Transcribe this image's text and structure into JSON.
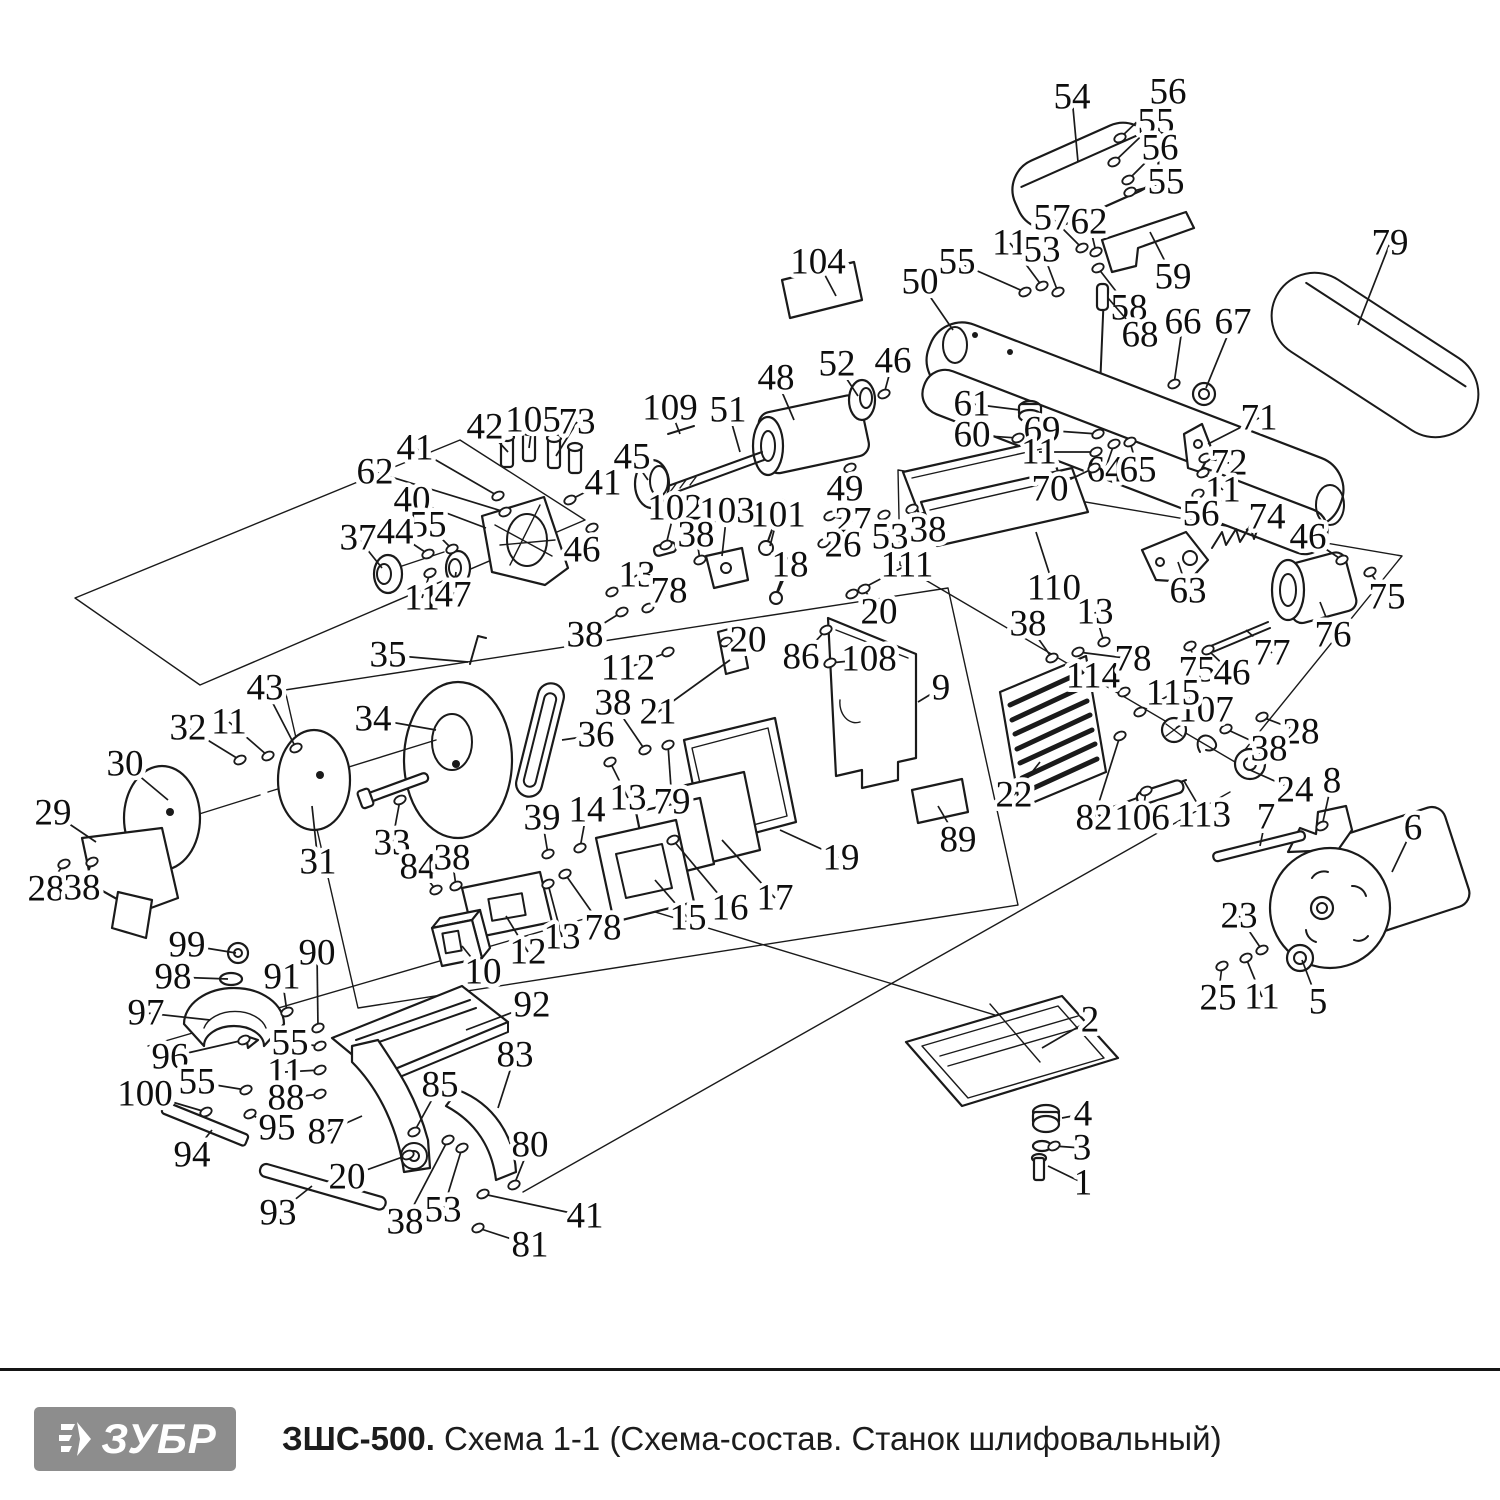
{
  "colors": {
    "line": "#1a1a1a",
    "logo_bg": "#8d8d8d",
    "logo_text": "#ffffff",
    "title_text": "#1c1c1c"
  },
  "footer": {
    "brand": "ЗУБР",
    "model": "ЗШС-500.",
    "subtitle": " Схема 1-1 (Схема-состав. Станок шлифовальный)"
  },
  "diagram": {
    "description": "Exploded-view parts diagram of belt/disc grinding machine",
    "callouts": [
      [
        "54",
        1072,
        97,
        1078,
        162,
        0
      ],
      [
        "56",
        1168,
        92,
        1120,
        138,
        1
      ],
      [
        "55",
        1156,
        122,
        1114,
        162,
        1
      ],
      [
        "56",
        1160,
        148,
        1128,
        180,
        1
      ],
      [
        "55",
        1166,
        182,
        1130,
        192,
        1
      ],
      [
        "57",
        1052,
        218,
        1082,
        248,
        1
      ],
      [
        "62",
        1089,
        222,
        1096,
        252,
        1
      ],
      [
        "59",
        1173,
        277,
        1150,
        232,
        0
      ],
      [
        "58",
        1129,
        308,
        1098,
        268,
        1
      ],
      [
        "68",
        1140,
        335,
        1108,
        298,
        0
      ],
      [
        "11",
        1010,
        243,
        1042,
        286,
        1
      ],
      [
        "53",
        1042,
        250,
        1058,
        292,
        1
      ],
      [
        "55",
        957,
        262,
        1025,
        292,
        1
      ],
      [
        "50",
        920,
        282,
        953,
        330,
        0
      ],
      [
        "104",
        818,
        262,
        836,
        296,
        0
      ],
      [
        "79",
        1390,
        243,
        1358,
        325,
        0
      ],
      [
        "66",
        1183,
        322,
        1174,
        384,
        1
      ],
      [
        "67",
        1233,
        322,
        1206,
        388,
        0
      ],
      [
        "71",
        1259,
        418,
        1208,
        444,
        0
      ],
      [
        "72",
        1229,
        463,
        1205,
        458,
        1
      ],
      [
        "11",
        1223,
        490,
        1203,
        473,
        1
      ],
      [
        "56",
        1201,
        514,
        1198,
        494,
        1
      ],
      [
        "74",
        1267,
        517,
        1246,
        530,
        0
      ],
      [
        "64",
        1105,
        470,
        1114,
        444,
        1
      ],
      [
        "65",
        1138,
        470,
        1130,
        442,
        1
      ],
      [
        "69",
        1042,
        430,
        1098,
        434,
        1
      ],
      [
        "11",
        1039,
        452,
        1096,
        452,
        1
      ],
      [
        "61",
        972,
        404,
        1020,
        410,
        0
      ],
      [
        "60",
        972,
        435,
        1018,
        438,
        1
      ],
      [
        "70",
        1050,
        489,
        1094,
        468,
        1
      ],
      [
        "46",
        1308,
        537,
        1342,
        560,
        1
      ],
      [
        "75",
        1387,
        597,
        1370,
        572,
        1
      ],
      [
        "76",
        1333,
        635,
        1320,
        602,
        0
      ],
      [
        "77",
        1272,
        653,
        1246,
        630,
        0
      ],
      [
        "75",
        1197,
        670,
        1190,
        646,
        1
      ],
      [
        "46",
        1232,
        673,
        1208,
        650,
        1
      ],
      [
        "63",
        1188,
        591,
        1178,
        562,
        0
      ],
      [
        "110",
        1054,
        588,
        1036,
        532,
        0
      ],
      [
        "52",
        837,
        364,
        858,
        396,
        0
      ],
      [
        "46",
        893,
        361,
        884,
        394,
        1
      ],
      [
        "48",
        776,
        378,
        794,
        420,
        0
      ],
      [
        "49",
        845,
        489,
        850,
        468,
        1
      ],
      [
        "51",
        728,
        410,
        740,
        452,
        0
      ],
      [
        "109",
        670,
        408,
        680,
        434,
        0
      ],
      [
        "45",
        632,
        457,
        648,
        480,
        0
      ],
      [
        "27",
        853,
        521,
        830,
        516,
        1
      ],
      [
        "26",
        843,
        545,
        824,
        543,
        1
      ],
      [
        "101",
        778,
        515,
        770,
        546,
        0
      ],
      [
        "102",
        675,
        508,
        666,
        545,
        1
      ],
      [
        "103",
        727,
        511,
        722,
        556,
        0
      ],
      [
        "38",
        696,
        535,
        700,
        560,
        1
      ],
      [
        "53",
        890,
        537,
        884,
        515,
        1
      ],
      [
        "38",
        928,
        530,
        912,
        509,
        1
      ],
      [
        "18",
        790,
        565,
        778,
        592,
        0
      ],
      [
        "111",
        907,
        565,
        852,
        594,
        1
      ],
      [
        "20",
        879,
        612,
        864,
        589,
        1
      ],
      [
        "86",
        801,
        657,
        826,
        630,
        1
      ],
      [
        "108",
        869,
        659,
        830,
        663,
        1
      ],
      [
        "9",
        941,
        688,
        918,
        702,
        0
      ],
      [
        "13",
        637,
        575,
        612,
        592,
        1
      ],
      [
        "78",
        669,
        591,
        648,
        608,
        1
      ],
      [
        "38",
        585,
        635,
        622,
        612,
        1
      ],
      [
        "112",
        628,
        668,
        668,
        652,
        1
      ],
      [
        "21",
        658,
        712,
        730,
        660,
        0
      ],
      [
        "20",
        748,
        640,
        726,
        642,
        1
      ],
      [
        "38",
        613,
        703,
        645,
        750,
        1
      ],
      [
        "36",
        596,
        735,
        562,
        740,
        0
      ],
      [
        "13",
        628,
        798,
        610,
        762,
        1
      ],
      [
        "79",
        672,
        802,
        668,
        745,
        1
      ],
      [
        "19",
        841,
        858,
        780,
        830,
        0
      ],
      [
        "89",
        958,
        840,
        938,
        806,
        0
      ],
      [
        "42",
        485,
        427,
        508,
        452,
        0
      ],
      [
        "105",
        533,
        420,
        529,
        448,
        0
      ],
      [
        "73",
        577,
        422,
        556,
        456,
        0
      ],
      [
        "41",
        415,
        448,
        498,
        496,
        1
      ],
      [
        "62",
        375,
        472,
        505,
        512,
        1
      ],
      [
        "40",
        412,
        500,
        486,
        528,
        0
      ],
      [
        "55",
        428,
        525,
        452,
        549,
        1
      ],
      [
        "44",
        395,
        532,
        428,
        554,
        1
      ],
      [
        "37",
        358,
        538,
        382,
        568,
        0
      ],
      [
        "41",
        603,
        483,
        570,
        500,
        1
      ],
      [
        "46",
        582,
        550,
        592,
        528,
        1
      ],
      [
        "11",
        422,
        598,
        430,
        573,
        1
      ],
      [
        "47",
        453,
        595,
        456,
        572,
        0
      ],
      [
        "35",
        388,
        655,
        468,
        662,
        0
      ],
      [
        "34",
        373,
        719,
        436,
        730,
        0
      ],
      [
        "43",
        265,
        688,
        296,
        748,
        1
      ],
      [
        "11",
        229,
        722,
        268,
        756,
        1
      ],
      [
        "32",
        188,
        728,
        240,
        760,
        1
      ],
      [
        "30",
        125,
        764,
        168,
        800,
        0
      ],
      [
        "29",
        53,
        813,
        96,
        842,
        0
      ],
      [
        "28",
        46,
        889,
        64,
        864,
        1
      ],
      [
        "38",
        82,
        888,
        92,
        862,
        1
      ],
      [
        "31",
        318,
        862,
        312,
        806,
        0
      ],
      [
        "33",
        392,
        843,
        400,
        800,
        1
      ],
      [
        "84",
        418,
        867,
        436,
        890,
        1
      ],
      [
        "38",
        452,
        858,
        456,
        886,
        1
      ],
      [
        "39",
        542,
        818,
        548,
        854,
        1
      ],
      [
        "14",
        587,
        810,
        580,
        848,
        1
      ],
      [
        "13",
        562,
        937,
        548,
        884,
        1
      ],
      [
        "78",
        603,
        928,
        565,
        874,
        1
      ],
      [
        "12",
        528,
        952,
        506,
        916,
        0
      ],
      [
        "10",
        483,
        972,
        462,
        946,
        0
      ],
      [
        "15",
        688,
        918,
        655,
        880,
        0
      ],
      [
        "16",
        730,
        908,
        673,
        840,
        1
      ],
      [
        "17",
        775,
        898,
        722,
        840,
        0
      ],
      [
        "99",
        187,
        945,
        236,
        953,
        0
      ],
      [
        "98",
        173,
        977,
        228,
        979,
        0
      ],
      [
        "97",
        146,
        1013,
        210,
        1020,
        0
      ],
      [
        "91",
        282,
        977,
        287,
        1012,
        1
      ],
      [
        "90",
        317,
        953,
        318,
        1028,
        1
      ],
      [
        "96",
        170,
        1057,
        244,
        1040,
        1
      ],
      [
        "55",
        290,
        1043,
        320,
        1046,
        1
      ],
      [
        "11",
        285,
        1072,
        320,
        1070,
        1
      ],
      [
        "88",
        286,
        1098,
        320,
        1094,
        1
      ],
      [
        "55",
        197,
        1082,
        246,
        1090,
        1
      ],
      [
        "100",
        145,
        1094,
        206,
        1112,
        1
      ],
      [
        "95",
        277,
        1128,
        250,
        1114,
        1
      ],
      [
        "94",
        192,
        1155,
        212,
        1130,
        0
      ],
      [
        "92",
        532,
        1005,
        466,
        1030,
        0
      ],
      [
        "83",
        515,
        1055,
        498,
        1108,
        0
      ],
      [
        "85",
        440,
        1085,
        414,
        1132,
        1
      ],
      [
        "87",
        326,
        1132,
        362,
        1116,
        0
      ],
      [
        "20",
        347,
        1177,
        408,
        1155,
        1
      ],
      [
        "93",
        278,
        1213,
        312,
        1186,
        0
      ],
      [
        "38",
        405,
        1222,
        448,
        1140,
        1
      ],
      [
        "53",
        443,
        1210,
        462,
        1148,
        1
      ],
      [
        "80",
        530,
        1145,
        514,
        1185,
        1
      ],
      [
        "41",
        585,
        1216,
        483,
        1194,
        1
      ],
      [
        "81",
        530,
        1245,
        478,
        1228,
        1
      ],
      [
        "22",
        1014,
        795,
        1040,
        762,
        0
      ],
      [
        "82",
        1094,
        818,
        1120,
        736,
        1
      ],
      [
        "106",
        1142,
        818,
        1146,
        791,
        1
      ],
      [
        "113",
        1204,
        815,
        1184,
        781,
        0
      ],
      [
        "24",
        1295,
        790,
        1250,
        770,
        0
      ],
      [
        "28",
        1301,
        732,
        1262,
        717,
        1
      ],
      [
        "38",
        1269,
        749,
        1226,
        729,
        1
      ],
      [
        "107",
        1206,
        710,
        1176,
        728,
        0
      ],
      [
        "114",
        1093,
        676,
        1124,
        692,
        1
      ],
      [
        "115",
        1173,
        693,
        1140,
        712,
        1
      ],
      [
        "13",
        1095,
        612,
        1104,
        642,
        1
      ],
      [
        "78",
        1133,
        659,
        1078,
        652,
        1
      ],
      [
        "38",
        1028,
        624,
        1052,
        658,
        1
      ],
      [
        "8",
        1332,
        781,
        1322,
        826,
        1
      ],
      [
        "7",
        1266,
        817,
        1260,
        846,
        0
      ],
      [
        "6",
        1413,
        828,
        1392,
        872,
        0
      ],
      [
        "23",
        1239,
        916,
        1262,
        950,
        1
      ],
      [
        "25",
        1218,
        998,
        1222,
        966,
        1
      ],
      [
        "11",
        1262,
        997,
        1246,
        958,
        1
      ],
      [
        "5",
        1318,
        1002,
        1302,
        960,
        0
      ],
      [
        "2",
        1090,
        1020,
        1042,
        1048,
        0
      ],
      [
        "4",
        1083,
        1114,
        1062,
        1118,
        0
      ],
      [
        "3",
        1082,
        1148,
        1054,
        1146,
        1
      ],
      [
        "1",
        1083,
        1183,
        1048,
        1166,
        0
      ]
    ]
  }
}
